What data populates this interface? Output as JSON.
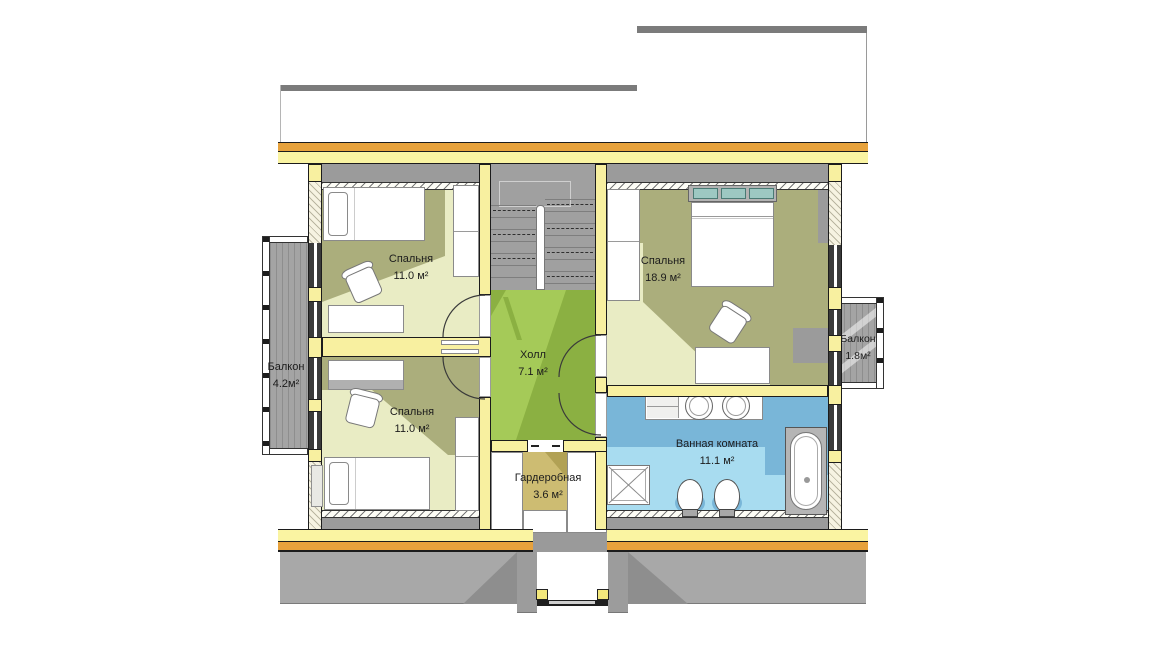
{
  "rooms": {
    "bedroom_top_left": {
      "name": "Спальня",
      "area": "11.0 м²"
    },
    "bedroom_bottom_left": {
      "name": "Спальня",
      "area": "11.0 м²"
    },
    "bedroom_right": {
      "name": "Спальня",
      "area": "18.9 м²"
    },
    "hall": {
      "name": "Холл",
      "area": "7.1 м²"
    },
    "wardrobe": {
      "name": "Гардеробная",
      "area": "3.6 м²"
    },
    "bathroom": {
      "name": "Ванная комната",
      "area": "11.1 м²"
    },
    "balcony_left": {
      "name": "Балкон",
      "area": "4.2м²"
    },
    "balcony_right": {
      "name": "Балкон",
      "area": "1.8м²"
    }
  },
  "palette": {
    "wall_yellow": "#F8F0A0",
    "band_yellow": "#FAF4A2",
    "band_orange": "#E7A23C",
    "floor_light": "#E9ECC4",
    "floor_olive": "#ABAE7C",
    "hall_green": "#A5CA58",
    "hall_green_dark": "#8BB042",
    "bath_blue": "#A8DCF0",
    "bath_blue_dark": "#79B6D8",
    "wardrobe_tan": "#CDBC72",
    "wardrobe_tan_dark": "#B1A155",
    "roof_edge_gray": "#7B7B7B",
    "slope_gray": "#A8A8A8",
    "slope_gray_dark": "#8E8E8E",
    "stair_gray": "#A0A0A0",
    "underroof_gray": "#9B9B9B",
    "deck_gray": "#A4A4A4",
    "frame_dark": "#3A3A3A"
  }
}
